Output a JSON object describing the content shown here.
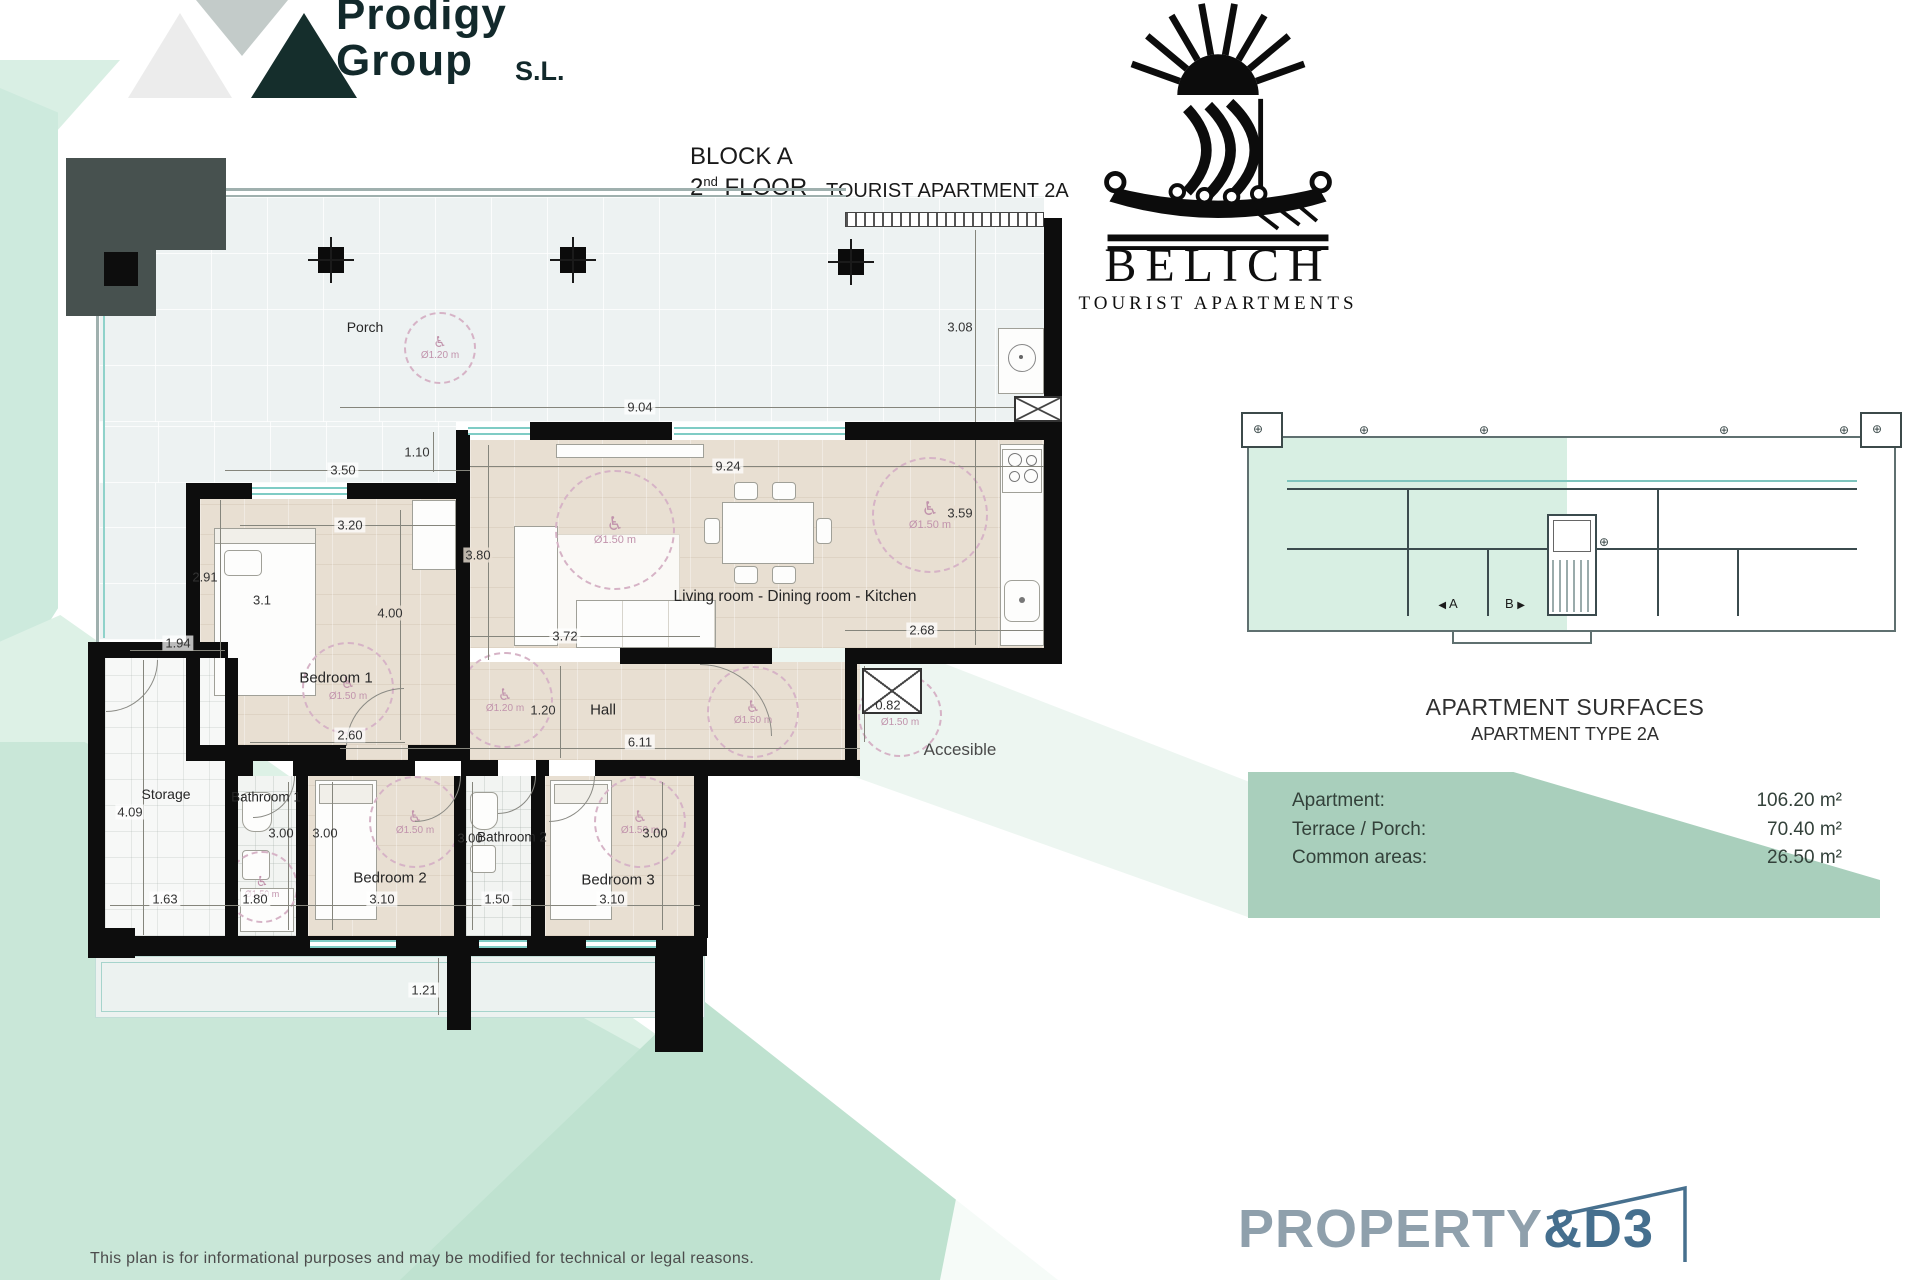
{
  "branding": {
    "prodigy": {
      "line1": "Prodigy",
      "line2": "Group",
      "suffix": "S.L."
    },
    "belich": {
      "name": "BELICH",
      "subtitle": "TOURIST APARTMENTS"
    },
    "property": {
      "main": "PROPERTY",
      "suffix": "&D3"
    }
  },
  "header": {
    "block": "BLOCK A",
    "floor_num": "2",
    "floor_ord": "nd",
    "floor_word": "FLOOR",
    "apartment": "TOURIST APARTMENT 2A"
  },
  "plan": {
    "rooms": {
      "porch": "Porch",
      "bedroom1": "Bedroom 1",
      "living": "Living room - Dining room - Kitchen",
      "hall": "Hall",
      "storage": "Storage",
      "bathroom1": "Bathroom 1",
      "bedroom2": "Bedroom 2",
      "bathroom2": "Bathroom 2",
      "bedroom3": "Bedroom 3",
      "accessible": "Accesible"
    },
    "dims": {
      "d904": "9.04",
      "d110": "1.10",
      "d924": "9.24",
      "d350": "3.50",
      "d320": "3.20",
      "d291": "2.91",
      "d31": "3.1",
      "d400": "4.00",
      "d194": "1.94",
      "d380": "3.80",
      "d372": "3.72",
      "d268": "2.68",
      "d308": "3.08",
      "d359": "3.59",
      "d120": "1.20",
      "d260": "2.60",
      "d611": "6.11",
      "d082": "0.82",
      "d409": "4.09",
      "d163": "1.63",
      "d180": "1.80",
      "d310": "3.10",
      "d150": "1.50",
      "d300": "3.00",
      "d121": "1.21"
    },
    "access": {
      "d120": "Ø1.20 m",
      "d150": "Ø1.50 m"
    }
  },
  "mini_plan": {
    "unit_a": "A",
    "unit_b": "B"
  },
  "surfaces": {
    "title": "APARTMENT SURFACES",
    "subtitle": "APARTMENT TYPE 2A",
    "rows": [
      {
        "label": "Apartment:",
        "value": "106.20 m²"
      },
      {
        "label": "Terrace / Porch:",
        "value": "70.40 m²"
      },
      {
        "label": "Common areas:",
        "value": "26.50 m²"
      }
    ]
  },
  "footer": {
    "disclaimer": "This plan is for informational purposes and may be modified for technical or legal reasons."
  },
  "icons": {
    "wheelchair": "♿",
    "position_marker": "⊕",
    "arrow_left": "◀",
    "arrow_right": "▶"
  }
}
